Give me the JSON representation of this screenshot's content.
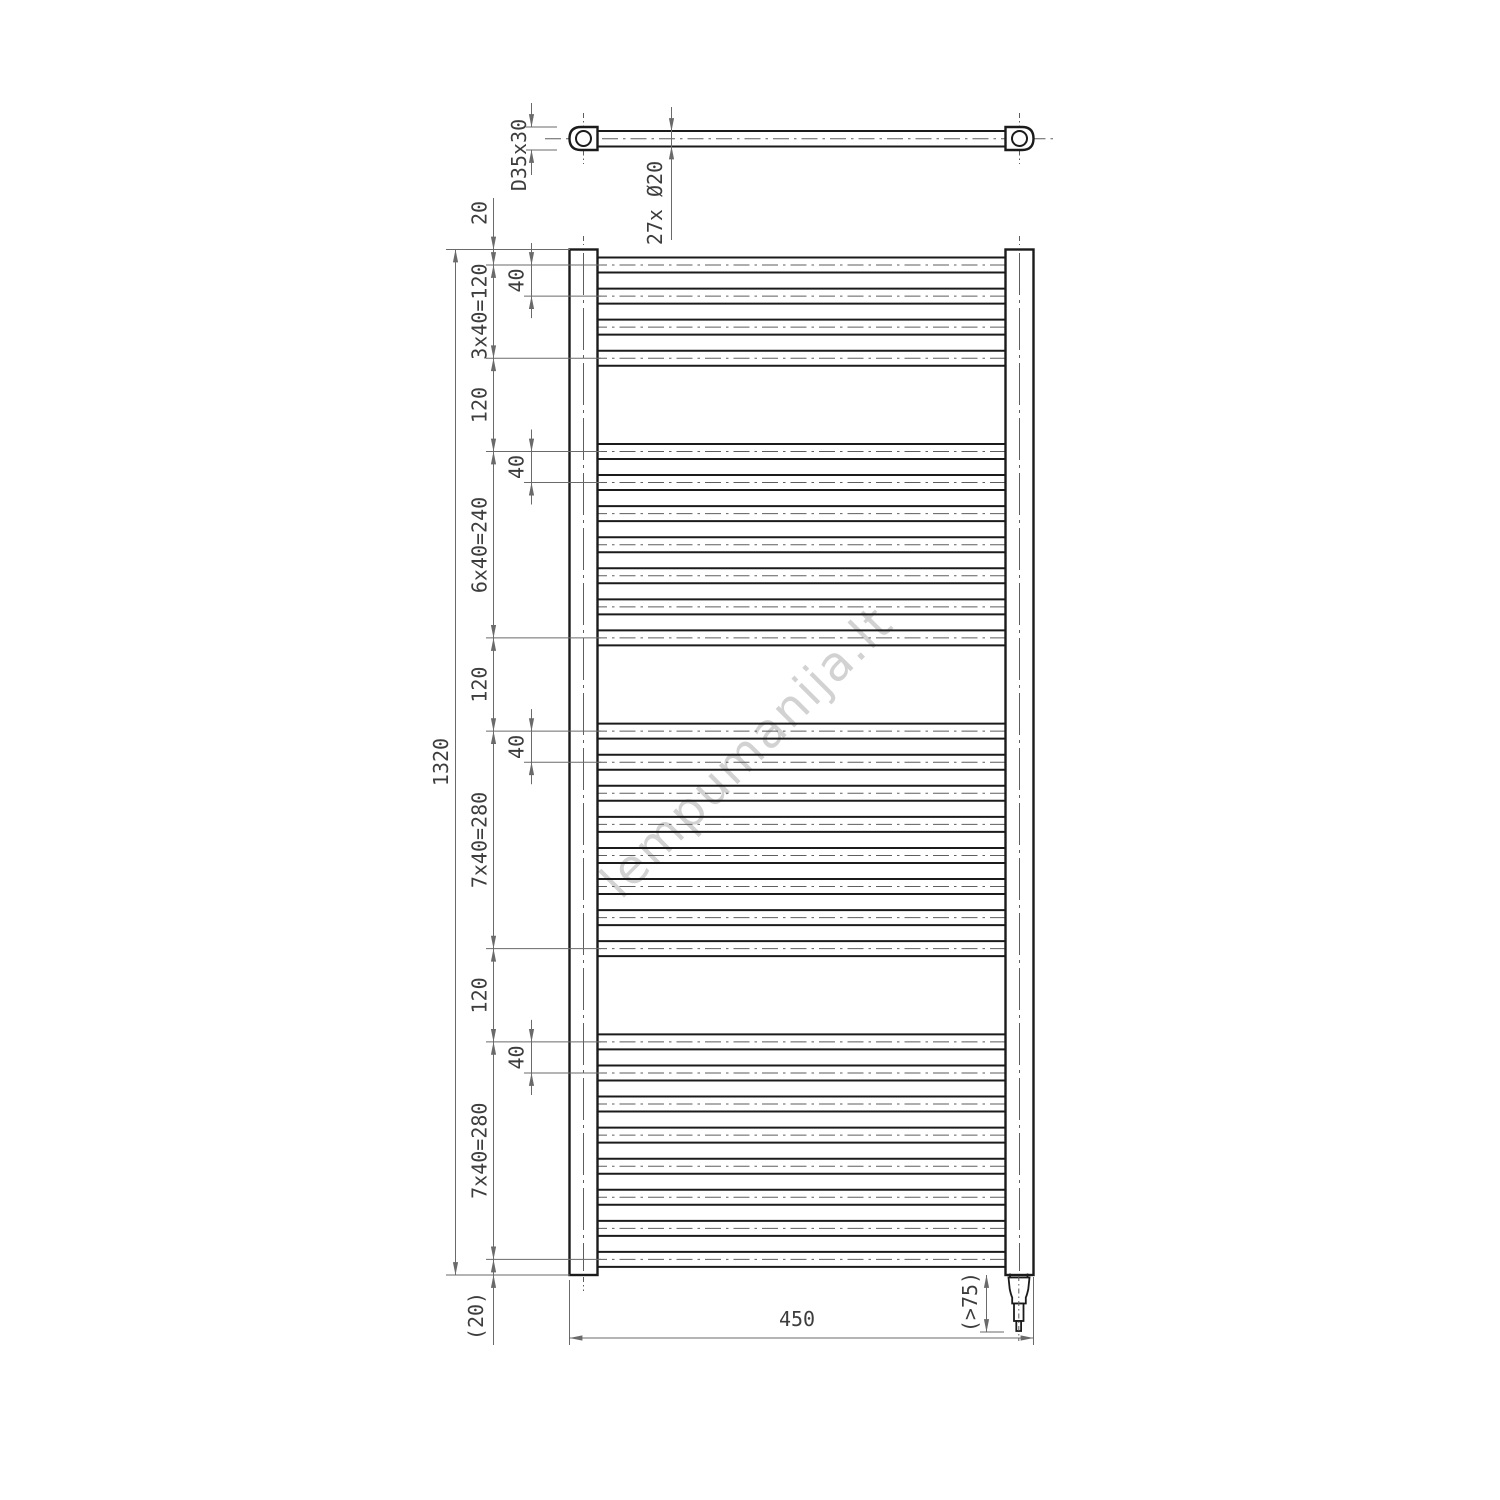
{
  "watermark": "lempumanija.lt",
  "top_view": {
    "profile": "D35x30",
    "tube_spec": "27x Ø20"
  },
  "front_view": {
    "total_height": "1320",
    "width": "450",
    "heater_clearance": "(>75)",
    "forty": "40",
    "chain_labels": [
      "20",
      "3x40=120",
      "120",
      "6x40=240",
      "120",
      "7x40=280",
      "120",
      "7x40=280",
      "(20)"
    ],
    "tube_count": 27,
    "tube_groups": [
      4,
      7,
      8,
      8
    ],
    "tube_pitch_mm": 40,
    "group_gap_mm": 120,
    "end_offset_mm": 20
  },
  "colors": {
    "object_line": "#1b1b1b",
    "dim_line": "#6a6a6a",
    "dim_text": "#3d3d3d",
    "watermark": "#c7c7c7"
  }
}
